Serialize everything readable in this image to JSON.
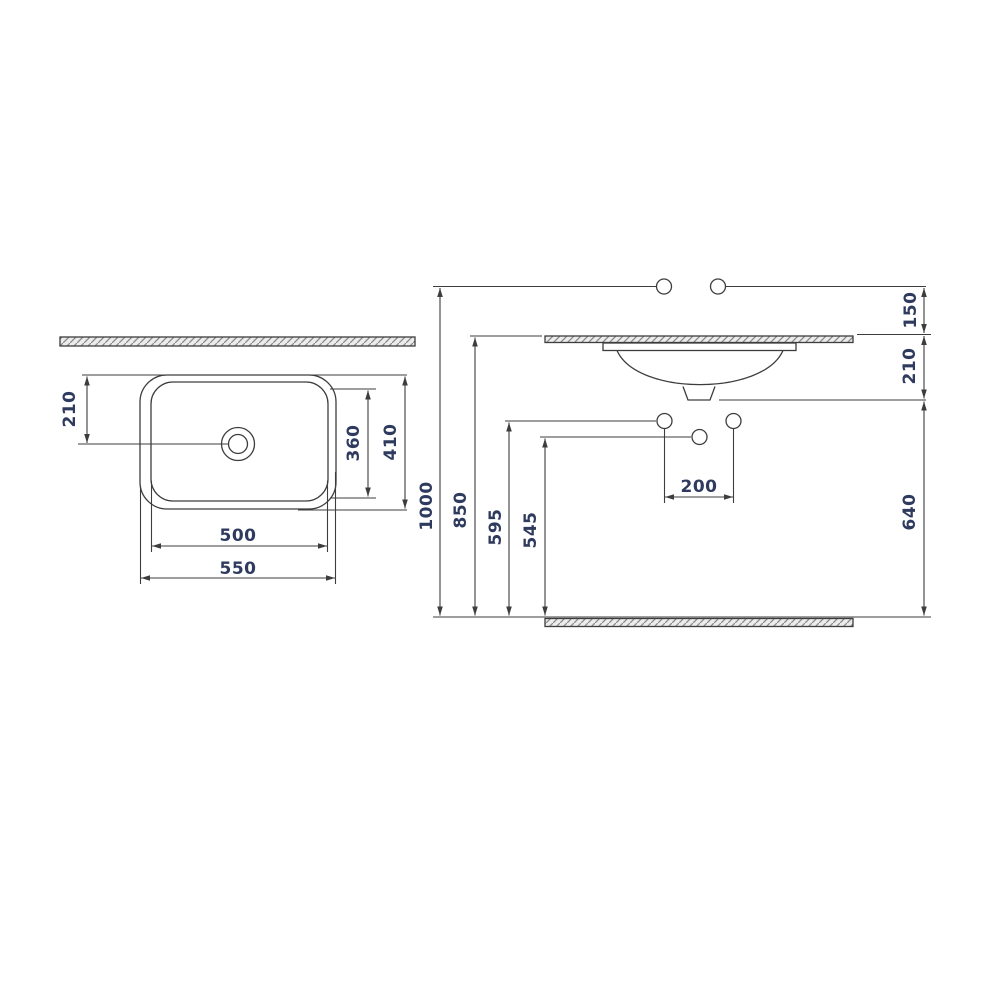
{
  "drawing": {
    "kind": "washbasin installation technical drawing",
    "background": "#ffffff",
    "line_color": "#3d3d3d",
    "text_color": "#2e3a5e",
    "plan_view": {
      "name": "basin plan (top) view",
      "dims": {
        "drain_offset_from_back": "210",
        "bowl_depth": "360",
        "overall_depth": "410",
        "bowl_width": "500",
        "overall_width": "550"
      }
    },
    "front_view": {
      "name": "basin installation front view",
      "dims": {
        "total_height": "1000",
        "countertop_height": "850",
        "supply_line_height": "595",
        "waste_line_height": "545",
        "supply_above_countertop": "150",
        "basin_below_countertop": "210",
        "supply_hole_spacing": "200",
        "waste_outlet_height": "640"
      }
    }
  }
}
